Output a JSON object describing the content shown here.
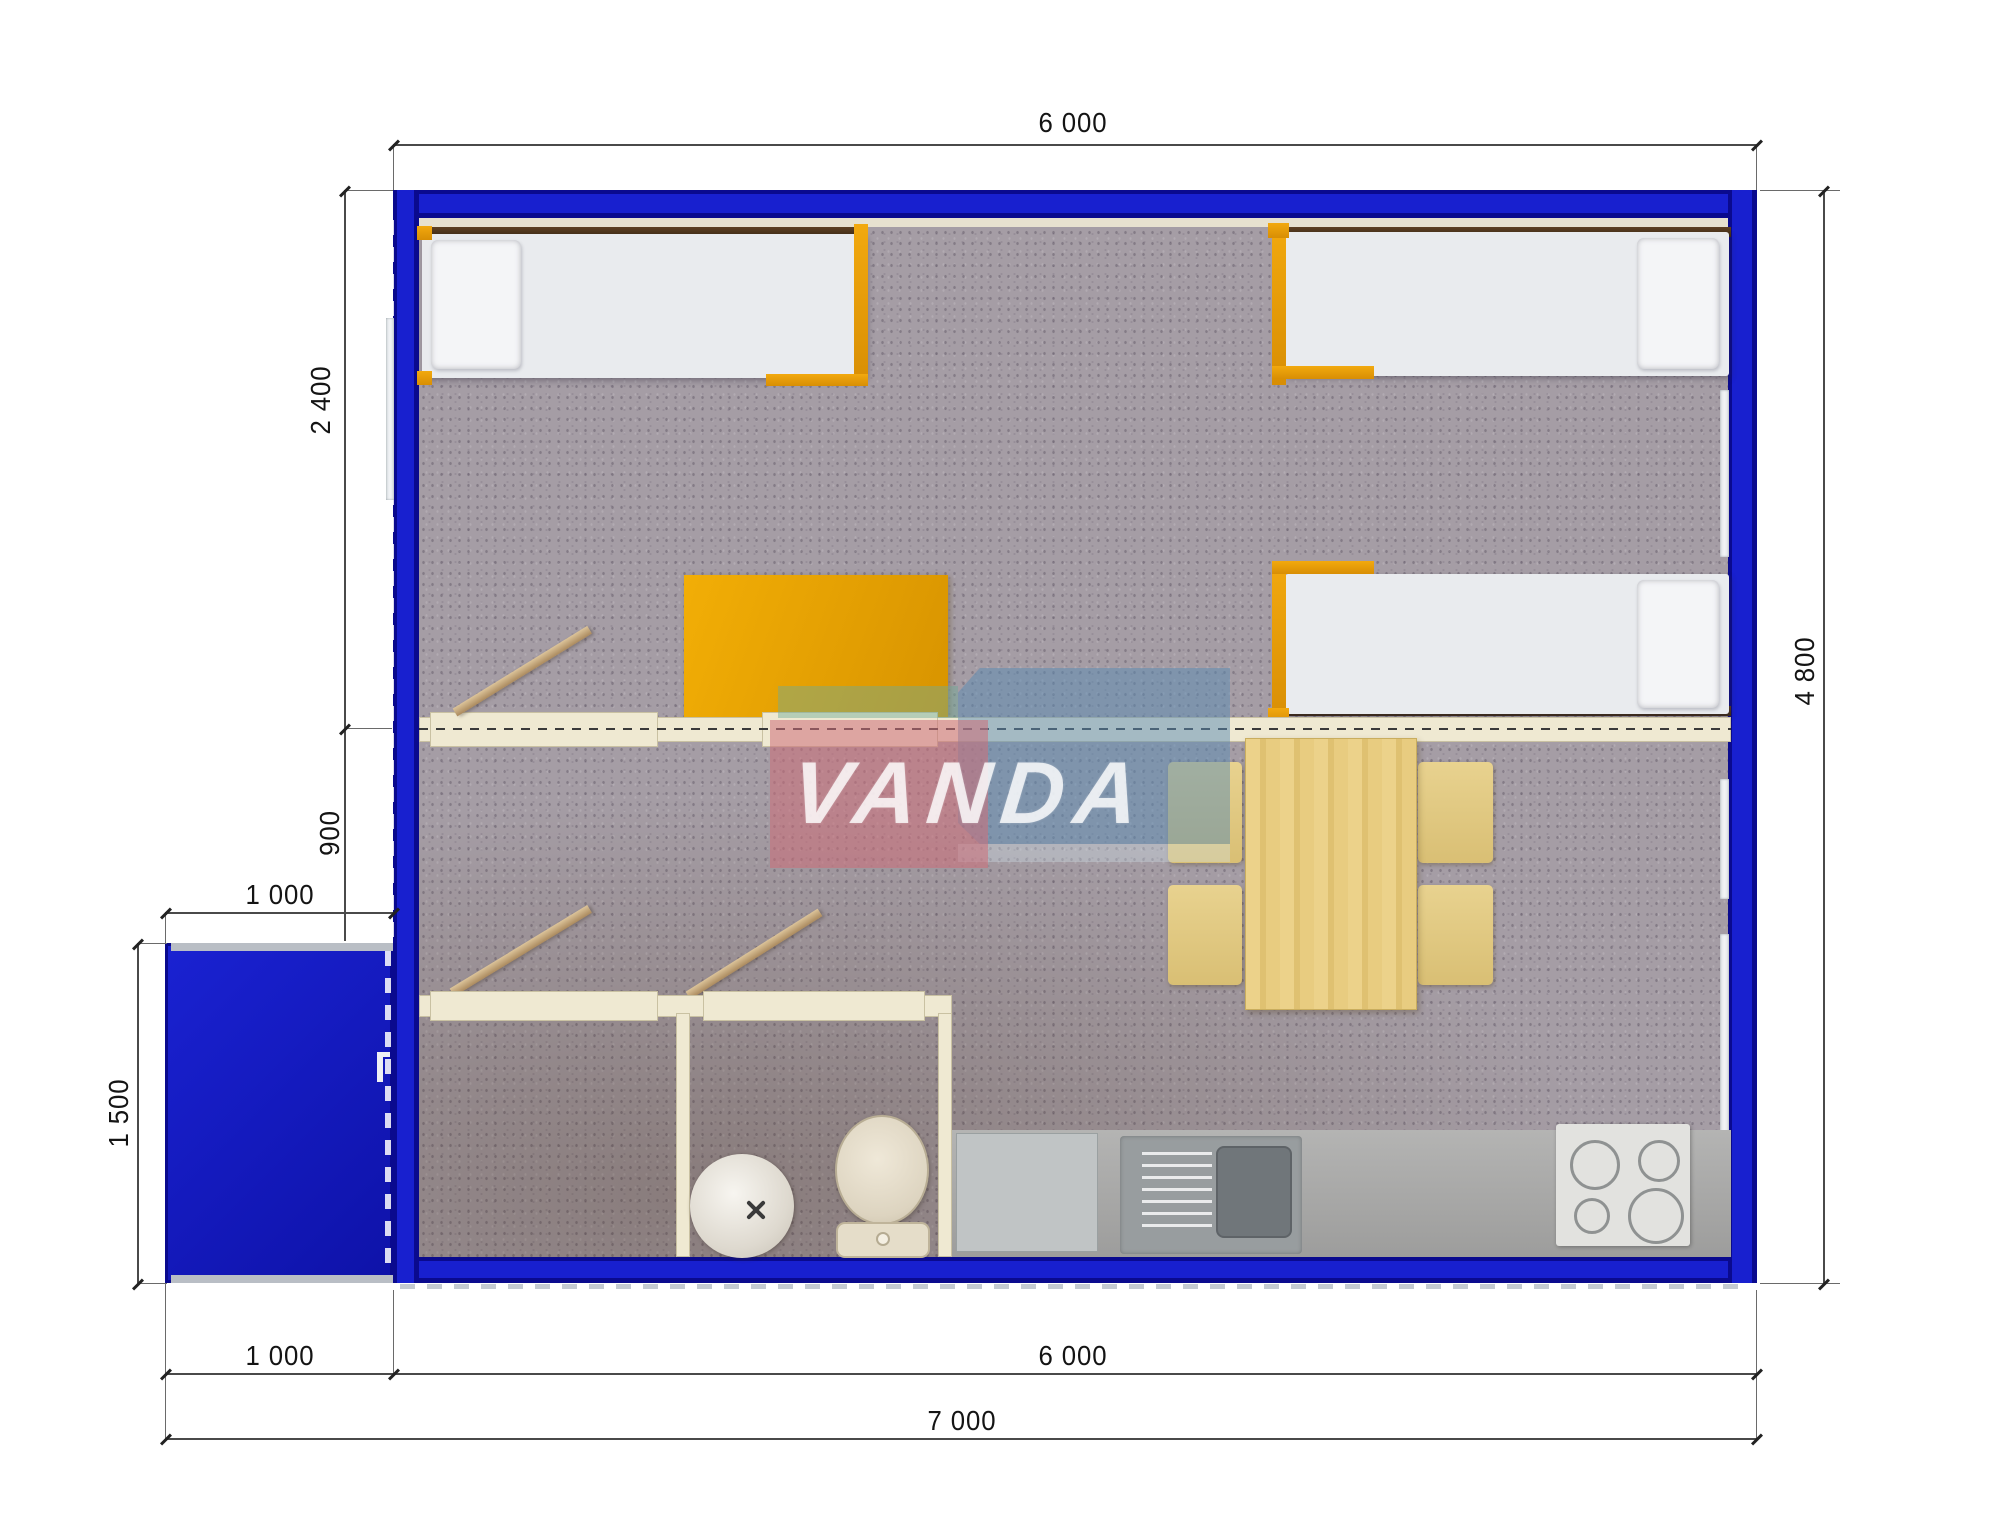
{
  "document": {
    "type": "floor-plan",
    "units": "mm"
  },
  "watermark": {
    "text": "VANDA"
  },
  "dimensions": {
    "top_width": "6 000",
    "left_room_depth": "2 400",
    "left_hall_depth": "900",
    "porch_width_top": "1 000",
    "porch_depth": "1 500",
    "bottom_porch_width": "1 000",
    "bottom_main_width": "6 000",
    "bottom_total_width": "7 000",
    "right_total_depth": "4 800"
  },
  "colors": {
    "wall_blue": "#1820cf",
    "wall_blue_dark": "#0a0a8e",
    "accent_orange": "#e89c0b",
    "carpet": "#a59da5",
    "wood_light": "#e6c97e",
    "cream_partition": "#efe9d2",
    "counter_gray": "#a7a7a6",
    "watermark_red": "rgba(205,110,120,0.55)",
    "watermark_blue": "rgba(90,140,180,0.50)",
    "watermark_teal": "rgba(110,170,150,0.45)"
  }
}
